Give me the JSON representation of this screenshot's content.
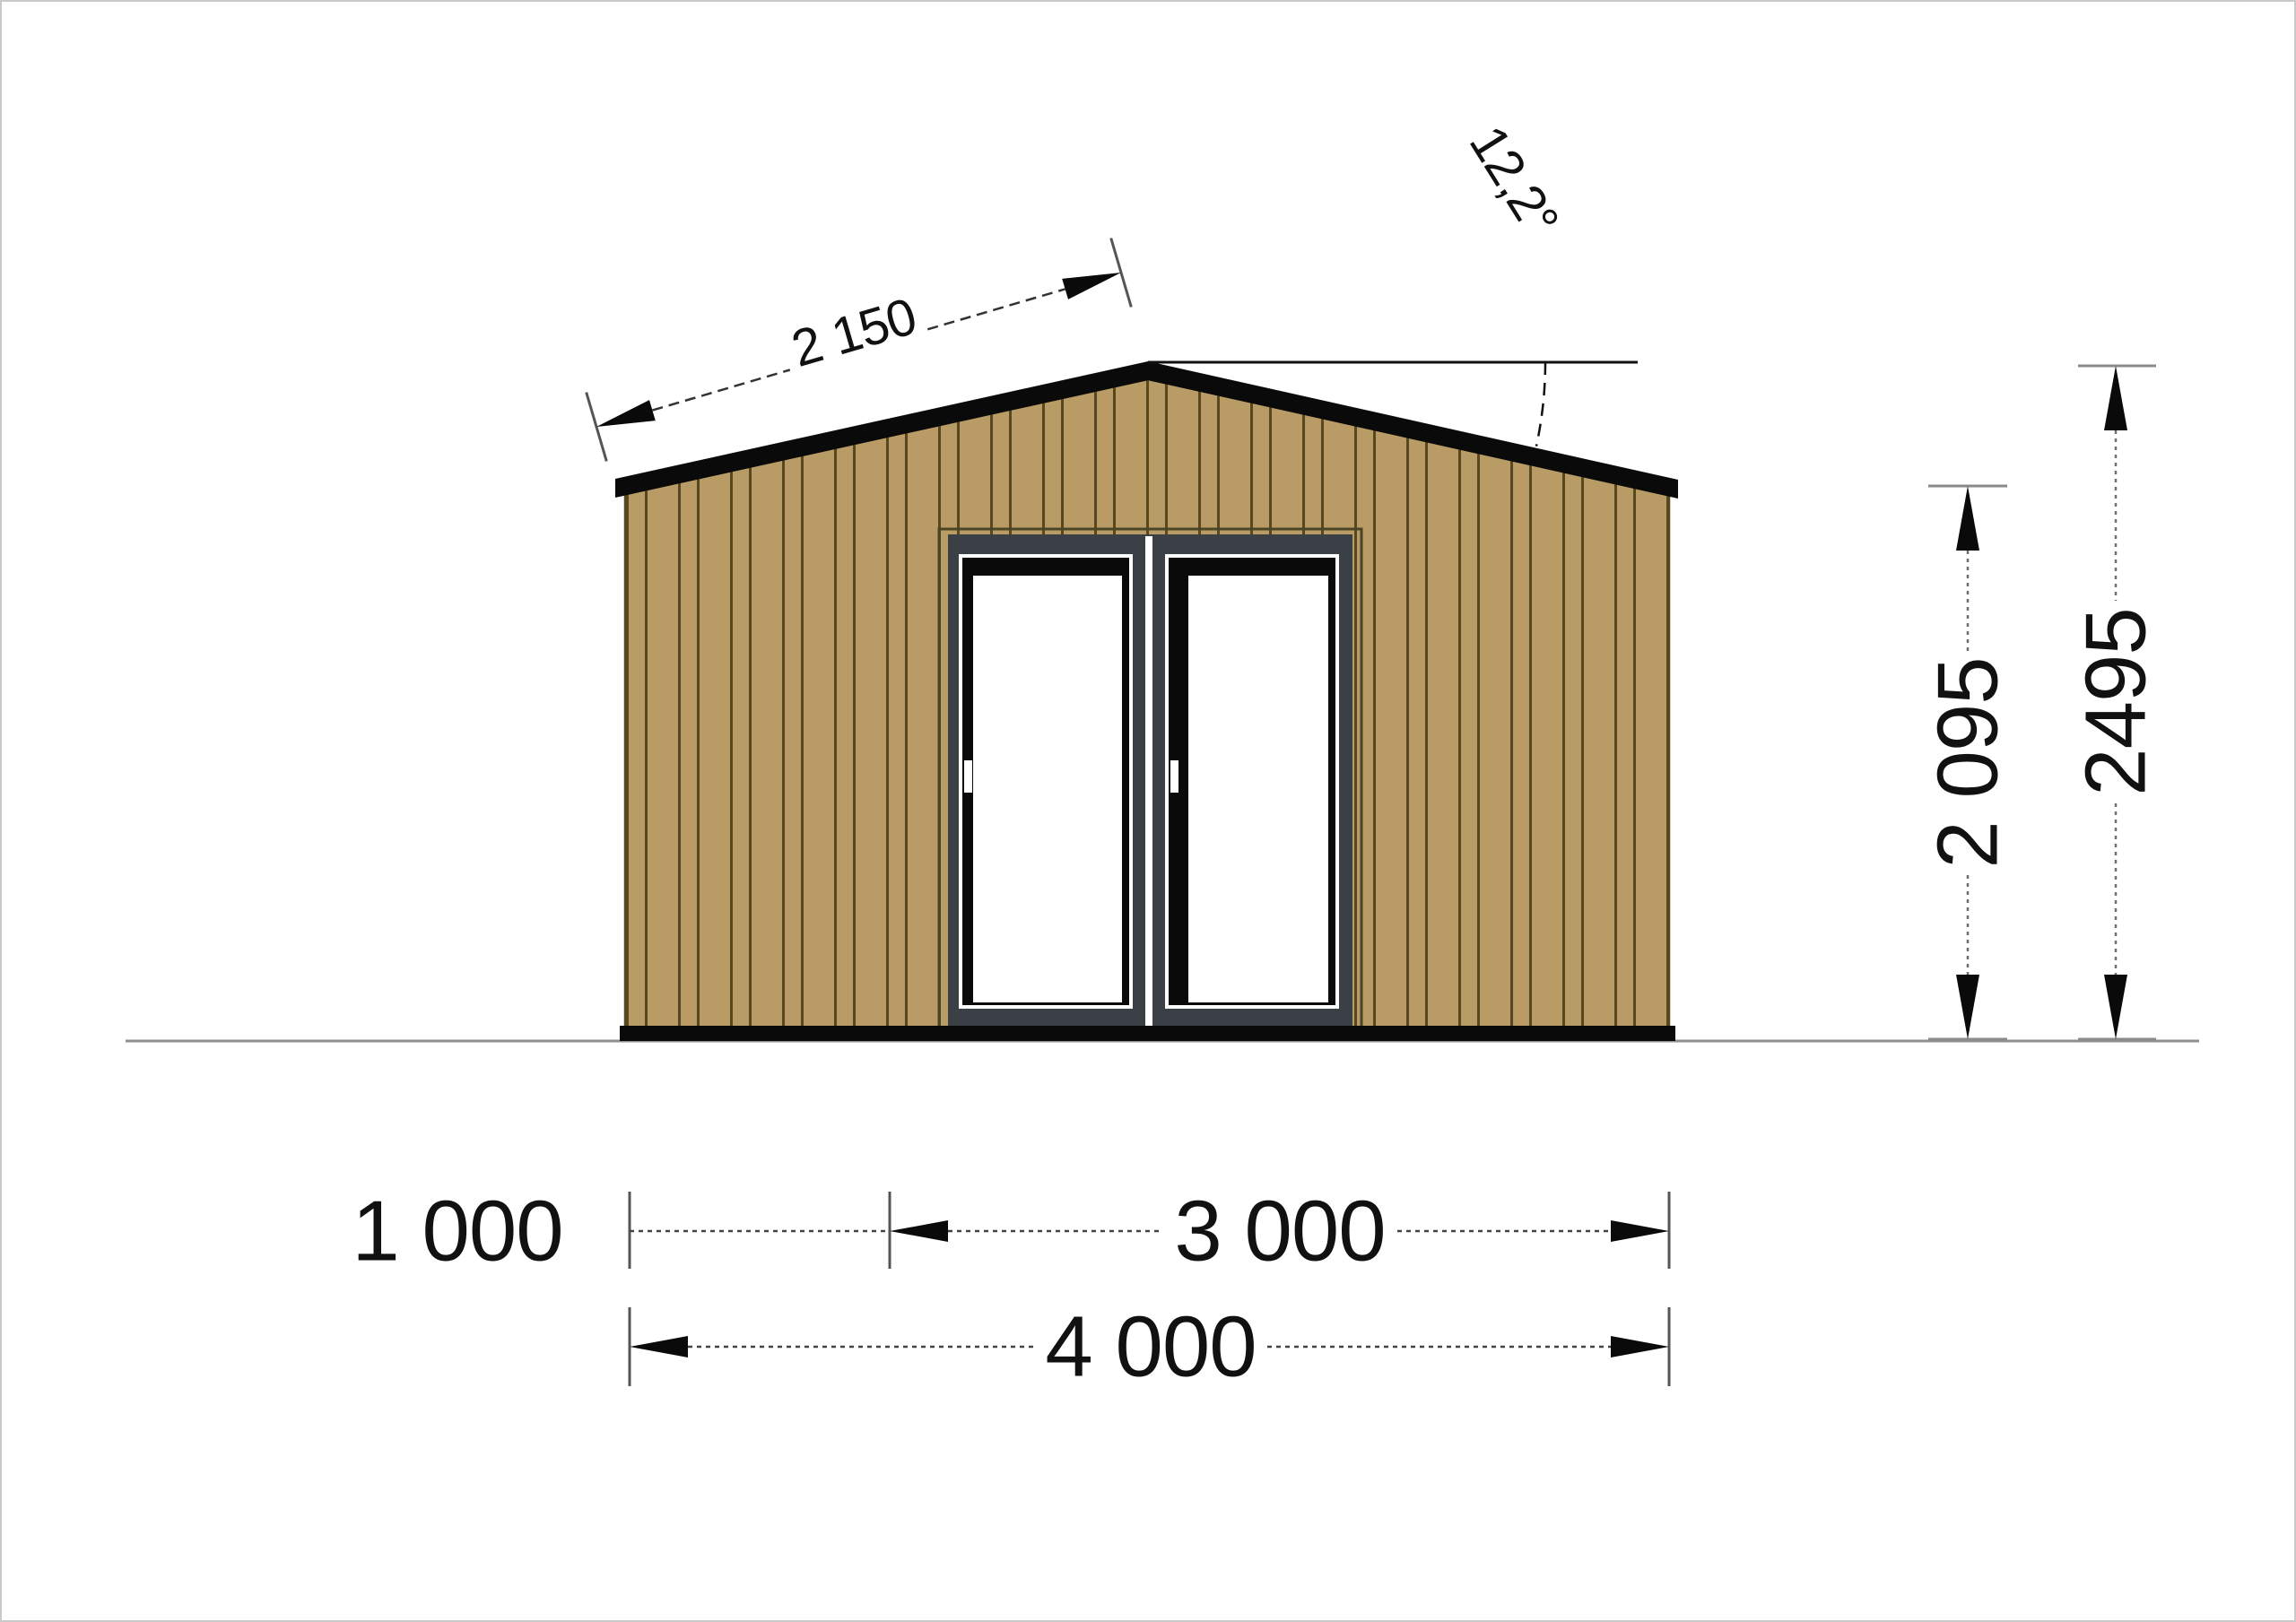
{
  "drawing": {
    "type": "front elevation",
    "dimensions": {
      "roof_slope_length": "2 150",
      "roof_angle": "12,2°",
      "wall_height": "2 095",
      "total_height": "2495",
      "left_offset": "1 000",
      "inner_span": "3 000",
      "total_width": "4 000"
    }
  },
  "colors": {
    "background": "#ffffff",
    "siding": "#b99b66",
    "plank_line": "#57481f",
    "trim_black": "#0a0a0a",
    "door_frame": "#3a4046",
    "door_outline": "#4c4426",
    "glass": "#ffffff",
    "ground_line": "#8d9091",
    "canvas_border": "#c9c9c9",
    "dim_text": "#111111"
  }
}
